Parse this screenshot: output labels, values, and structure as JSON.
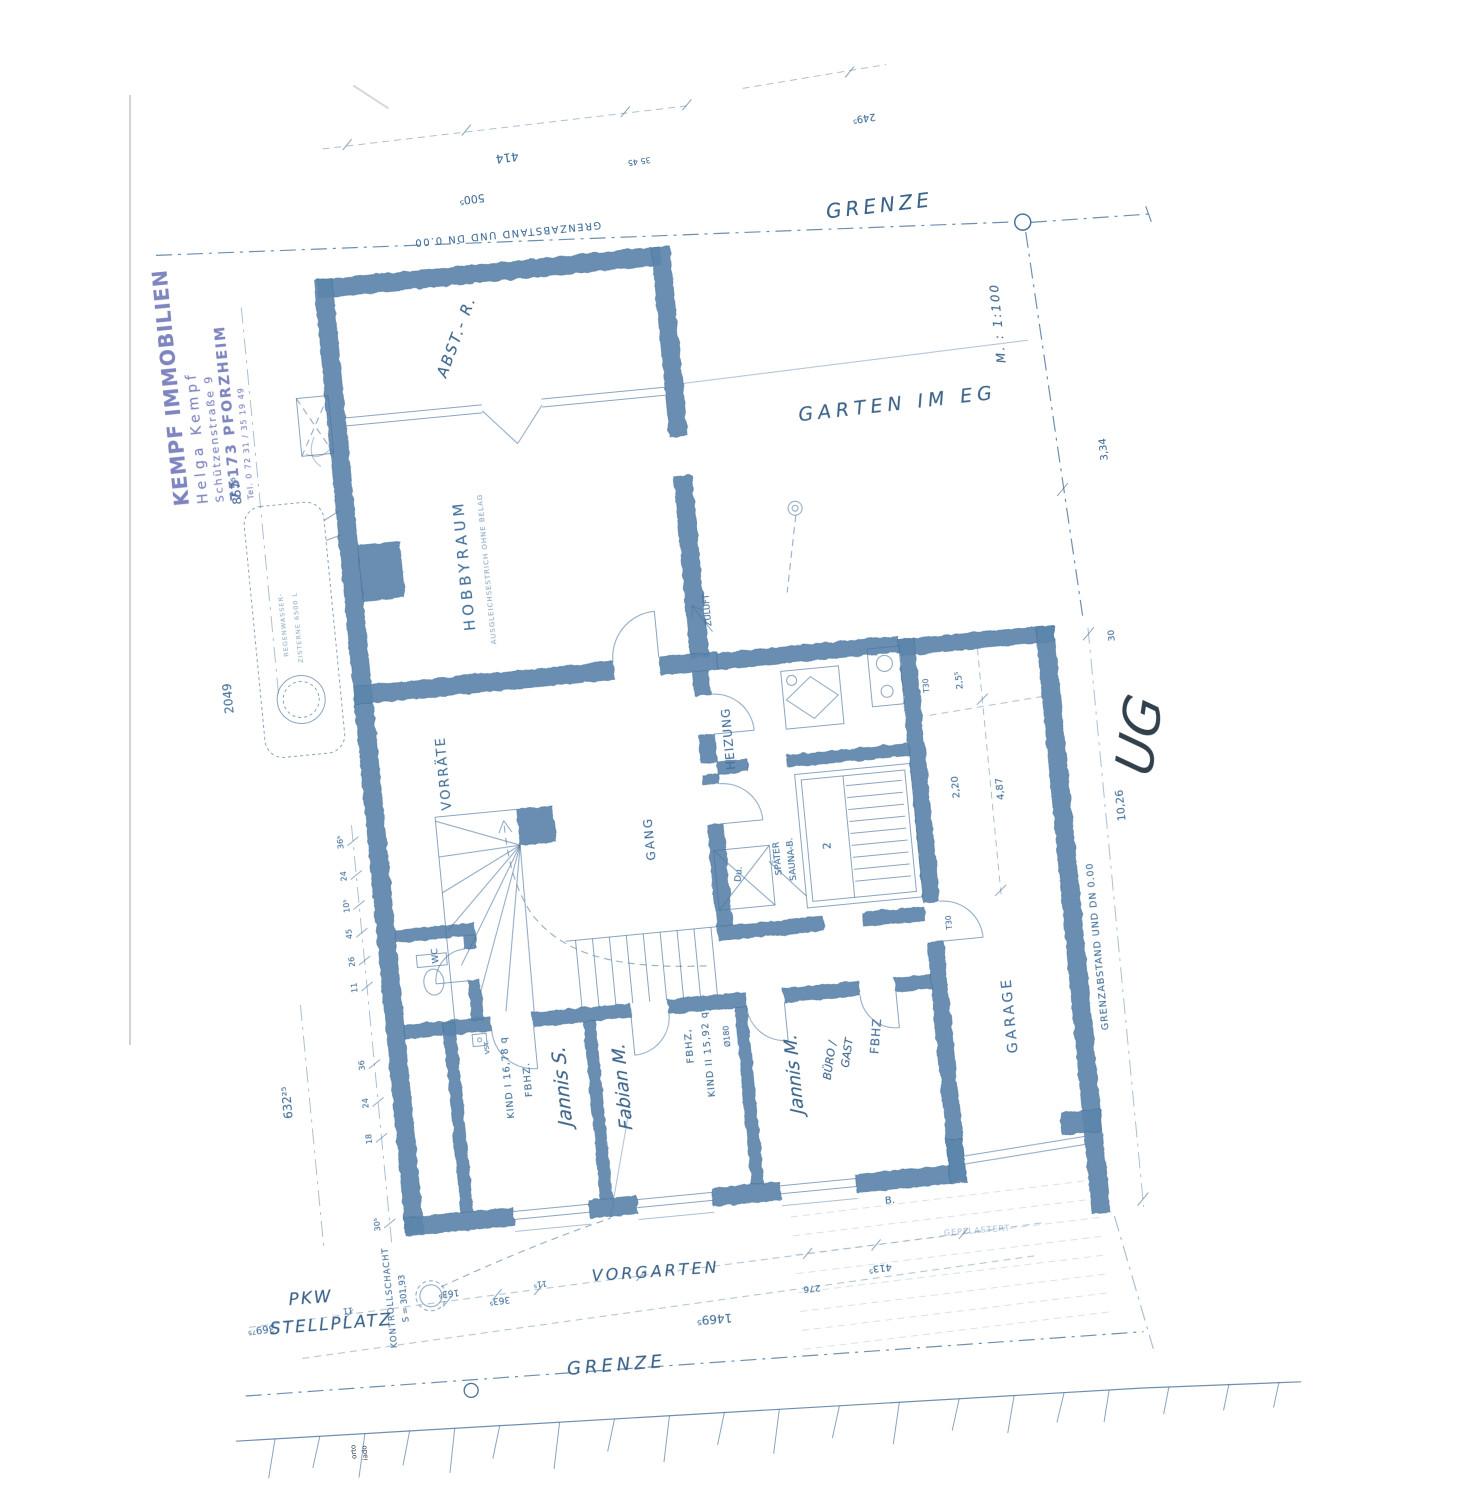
{
  "colors": {
    "ink": "#45719a",
    "wall": "#5d86ac",
    "stamp": "#5a63ad",
    "dark_ink": "#32404c"
  },
  "stamp": {
    "line1": "KEMPF IMMOBILIEN",
    "line2": "Helga Kempf",
    "line3": "Schützenstraße 9",
    "line4": "75173 PFORZHEIM",
    "line5": "Tel. 0 72 31 / 35 19 49"
  },
  "labels": {
    "grenze_top": "GRENZE",
    "grenze_bottom": "GRENZE",
    "garten_im_eg": "GARTEN IM EG",
    "scale": "M. : 1:100",
    "vorgarten": "VORGARTEN",
    "pkw": "PKW",
    "stellplatz": "STELLPLATZ",
    "kontrollschacht_1": "KONTROLLSCHACHT",
    "kontrollschacht_2": "S = 301,93",
    "ug": "UG",
    "grenzabstand_top": "GRENZABSTAND UND DN 0.00",
    "grenzabstand_right": "GRENZABSTAND UND DN 0.00",
    "abst_r": "ABST.- R.",
    "hobbyraum": "HOBBYRAUM",
    "hobby_sub": "AUSGLEICHSESTRICH OHNE BELAG",
    "vorraete": "VORRÄTE",
    "gang": "GANG",
    "heizung": "HEIZUNG",
    "zuluft": "ZULUFT",
    "spaeter": "SPÄTER",
    "sauna_b": "SAUNA-B.",
    "du": "Du.",
    "sauna_nr": "2",
    "wc": "WC",
    "vst": "VST.",
    "kind1": "KIND I  16,78 q",
    "fbhz1": "FBHZ.",
    "jannis_s": "Jannis S.",
    "fabian_m": "Fabian M.",
    "fbhz2": "FBHZ,",
    "kind2": "KIND II  15,92 q",
    "durchmesser": "Ø180",
    "jannis_m": "Jannis M.",
    "buero": "BÜRO /",
    "gast": "GAST",
    "fbhz3": "FBHZ",
    "t30_a": "T30",
    "t30_b": "T30",
    "garage": "GARAGE",
    "b_dot": "B.",
    "gepflastert": "GEPFLASTERT",
    "cistern_1": "REGENWASSER-",
    "cistern_2": "ZISTERNE 6500 L"
  },
  "dims": {
    "left_major": [
      "857⁵",
      "2049",
      "632²⁵"
    ],
    "left_chain": [
      "36⁵",
      "24",
      "10⁵",
      "45",
      "26",
      "11",
      "36",
      "24",
      "18",
      "30⁵"
    ],
    "top_row": [
      "414",
      "500⁵",
      "249⁵",
      "35  45"
    ],
    "vorgarten_row": [
      "369⁷⁵",
      "11",
      "163⁵",
      "363⁵",
      "11⁵",
      "1469⁵",
      "276",
      "413⁵"
    ],
    "right_col": [
      "3,34",
      "30",
      "10,26"
    ],
    "garage_inner": [
      "2,5⁵",
      "2,20",
      "4,87"
    ],
    "artifact_text": [
      "orto",
      "iado"
    ]
  }
}
